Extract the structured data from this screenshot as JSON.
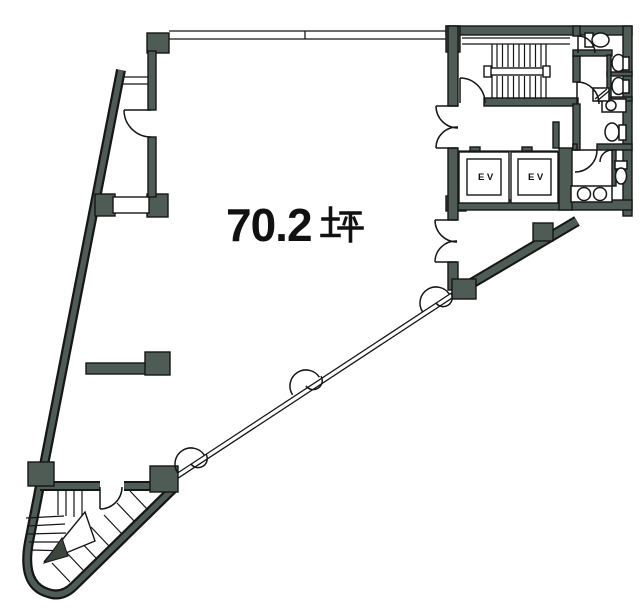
{
  "document": {
    "type": "floor-plan",
    "style": "japanese-real-estate-plan"
  },
  "labels": {
    "area": {
      "text": "70.2坪",
      "value": "70.2",
      "unit_glyph": "坪"
    },
    "elevators": [
      {
        "label": "EV"
      },
      {
        "label": "EV"
      }
    ]
  },
  "rooms": {
    "main_area_tsubo": 70.2,
    "elevator_count": 2,
    "has_main_staircase": true,
    "has_winder_staircase": true,
    "has_restrooms": true,
    "has_kitchenette_sink": true
  },
  "icons": {
    "tsubo-unit-glyph": "坪",
    "toilet-icon": "toilet",
    "sink-icon": "sink",
    "urinal-icon": "urinal",
    "door-swing-icon": "quarter-circle",
    "stair-direction-arrow": "triangle-arrow"
  },
  "colors": {
    "wall_fill": "#4e5c55",
    "outline": "#161616",
    "background": "#ffffff",
    "text": "#111111"
  }
}
